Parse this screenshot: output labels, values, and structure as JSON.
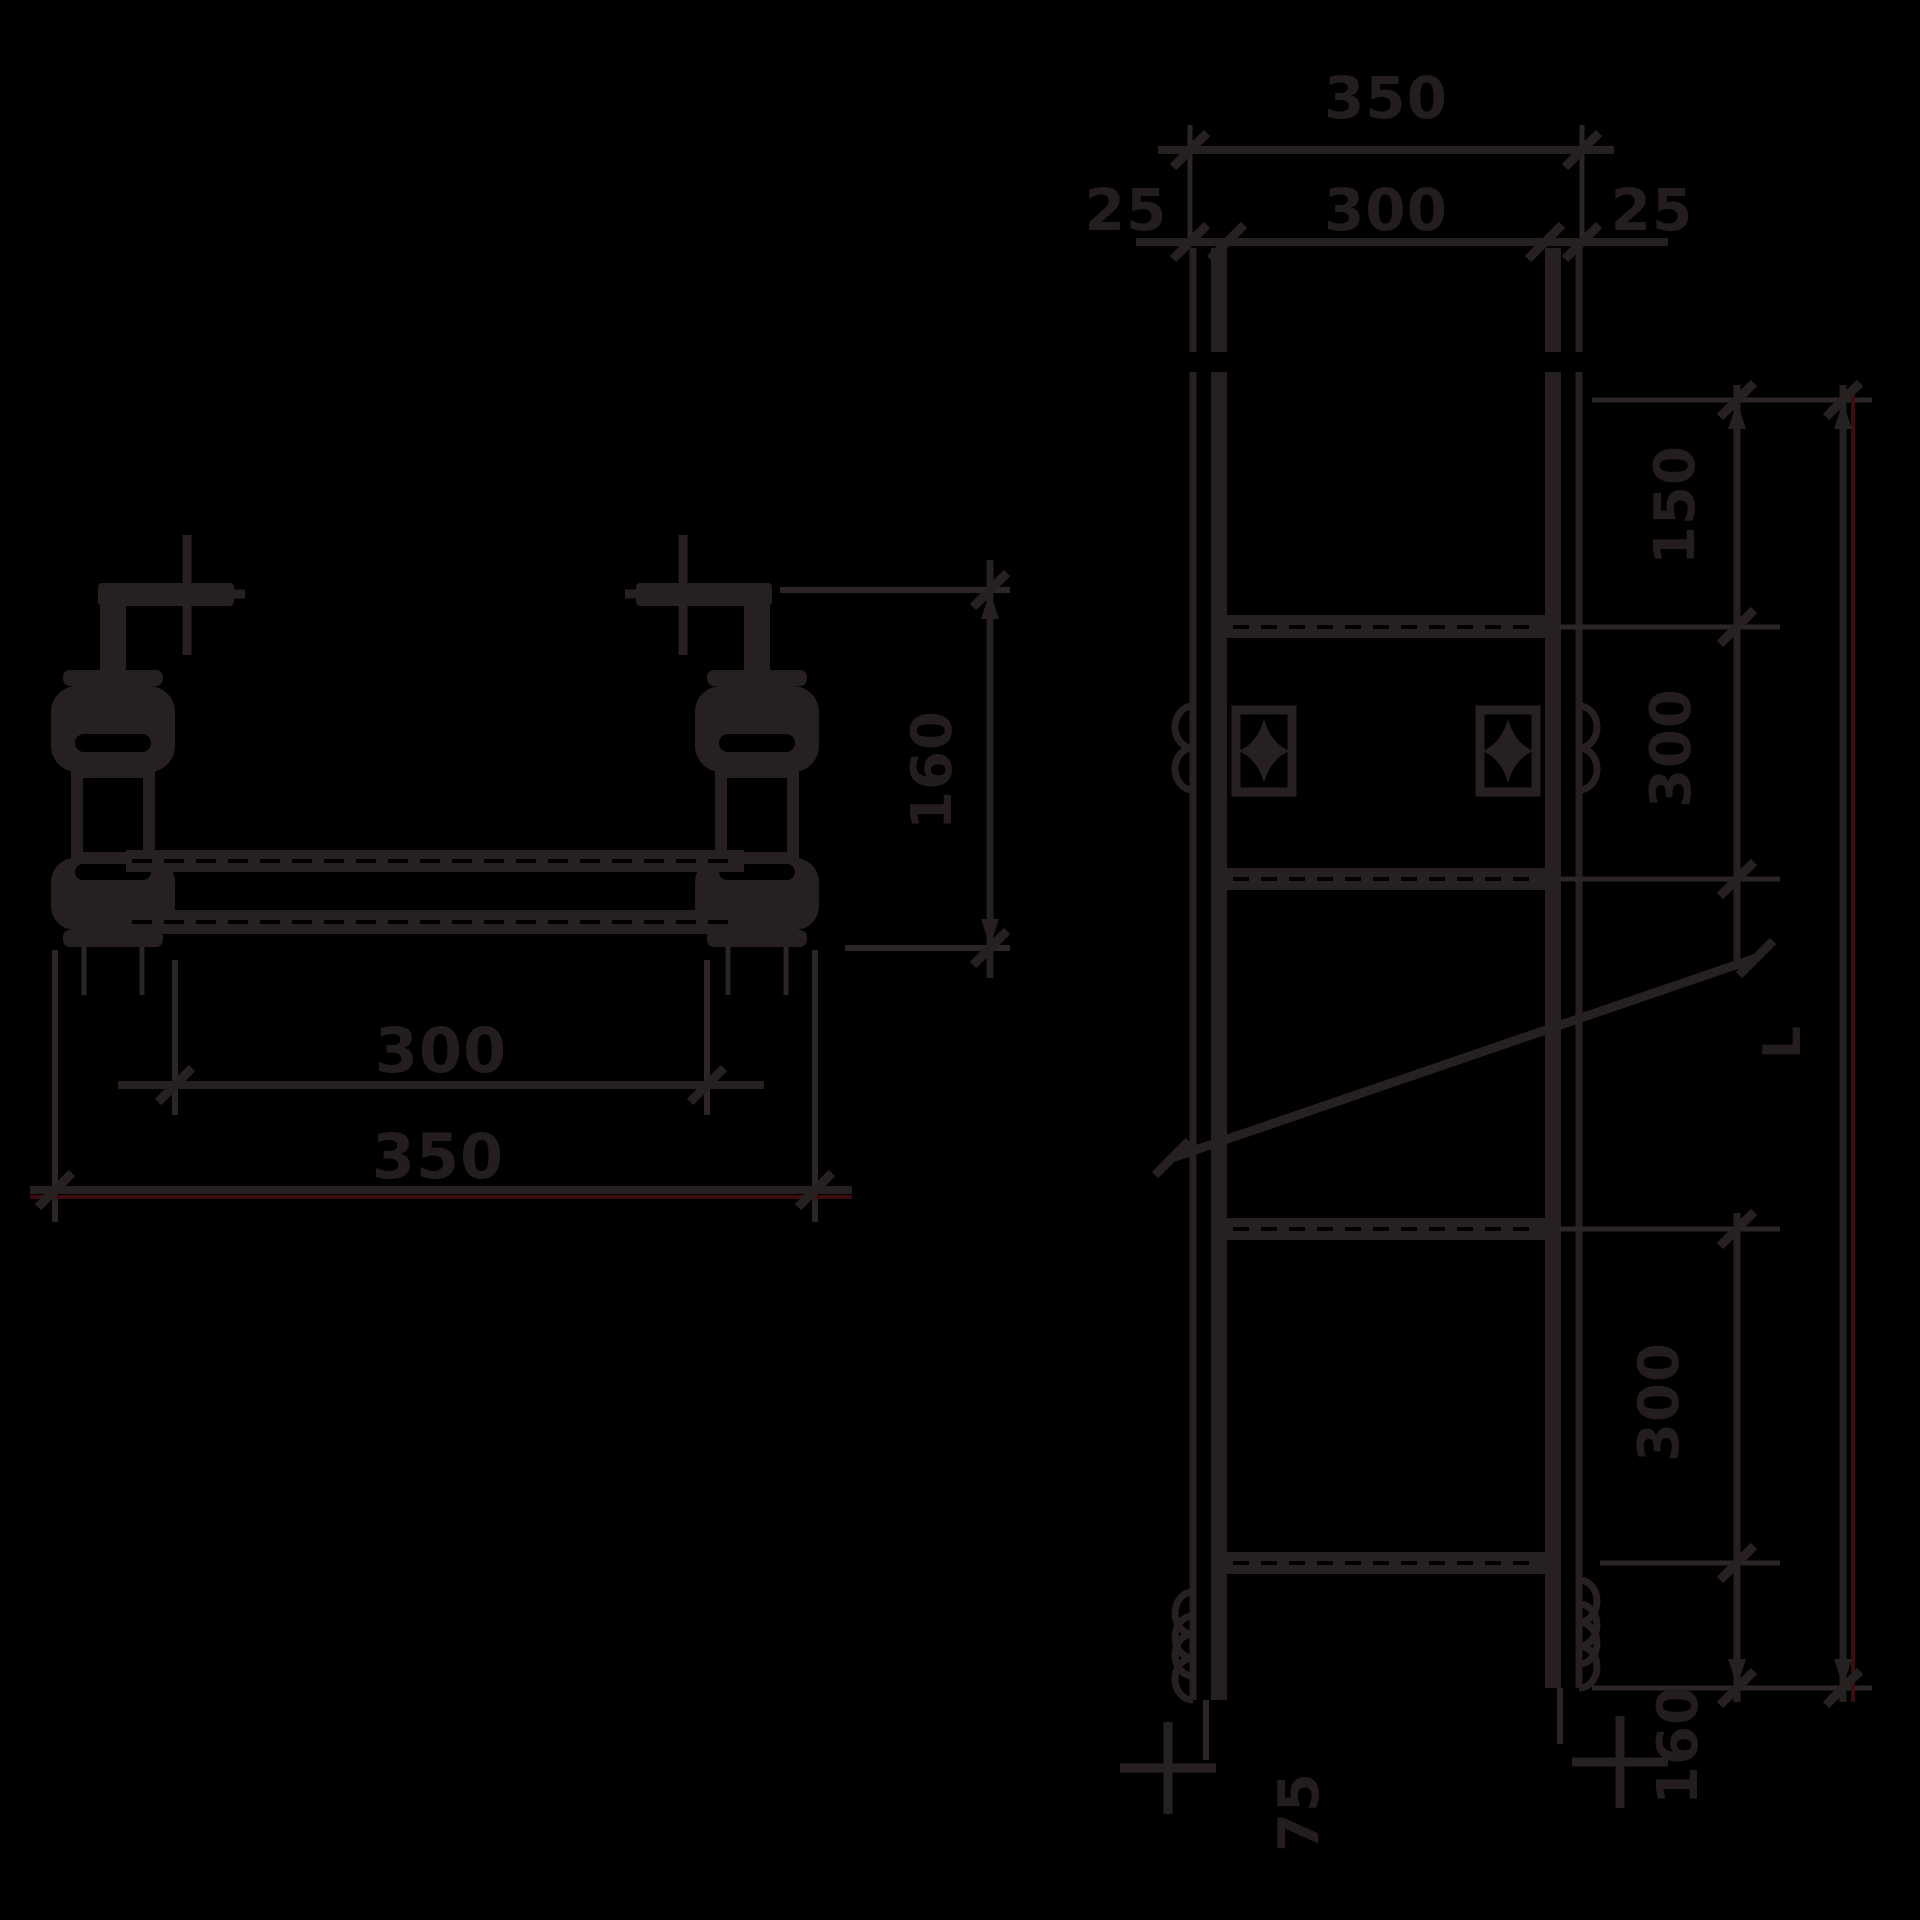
{
  "drawing": {
    "type": "technical-dimension-drawing",
    "background": "#000000",
    "line_color": "#262021",
    "red_artifact_color": "#3a0e11",
    "left_view": {
      "description": "front elevation of roller bracket assembly",
      "dim_inner_width": "300",
      "dim_outer_width": "350",
      "dim_height": "160"
    },
    "right_view": {
      "description": "plan view of cable ladder with rungs",
      "dim_width_outer": "350",
      "dim_width_inner": "300",
      "dim_flange_left": "25",
      "dim_flange_right": "25",
      "dim_top_spacing": "150",
      "dim_rung_spacing_upper": "300",
      "dim_rung_spacing_lower": "300",
      "dim_bottom_section": "160",
      "dim_overall_length_label": "L",
      "dim_bottom_offset": "75"
    }
  }
}
